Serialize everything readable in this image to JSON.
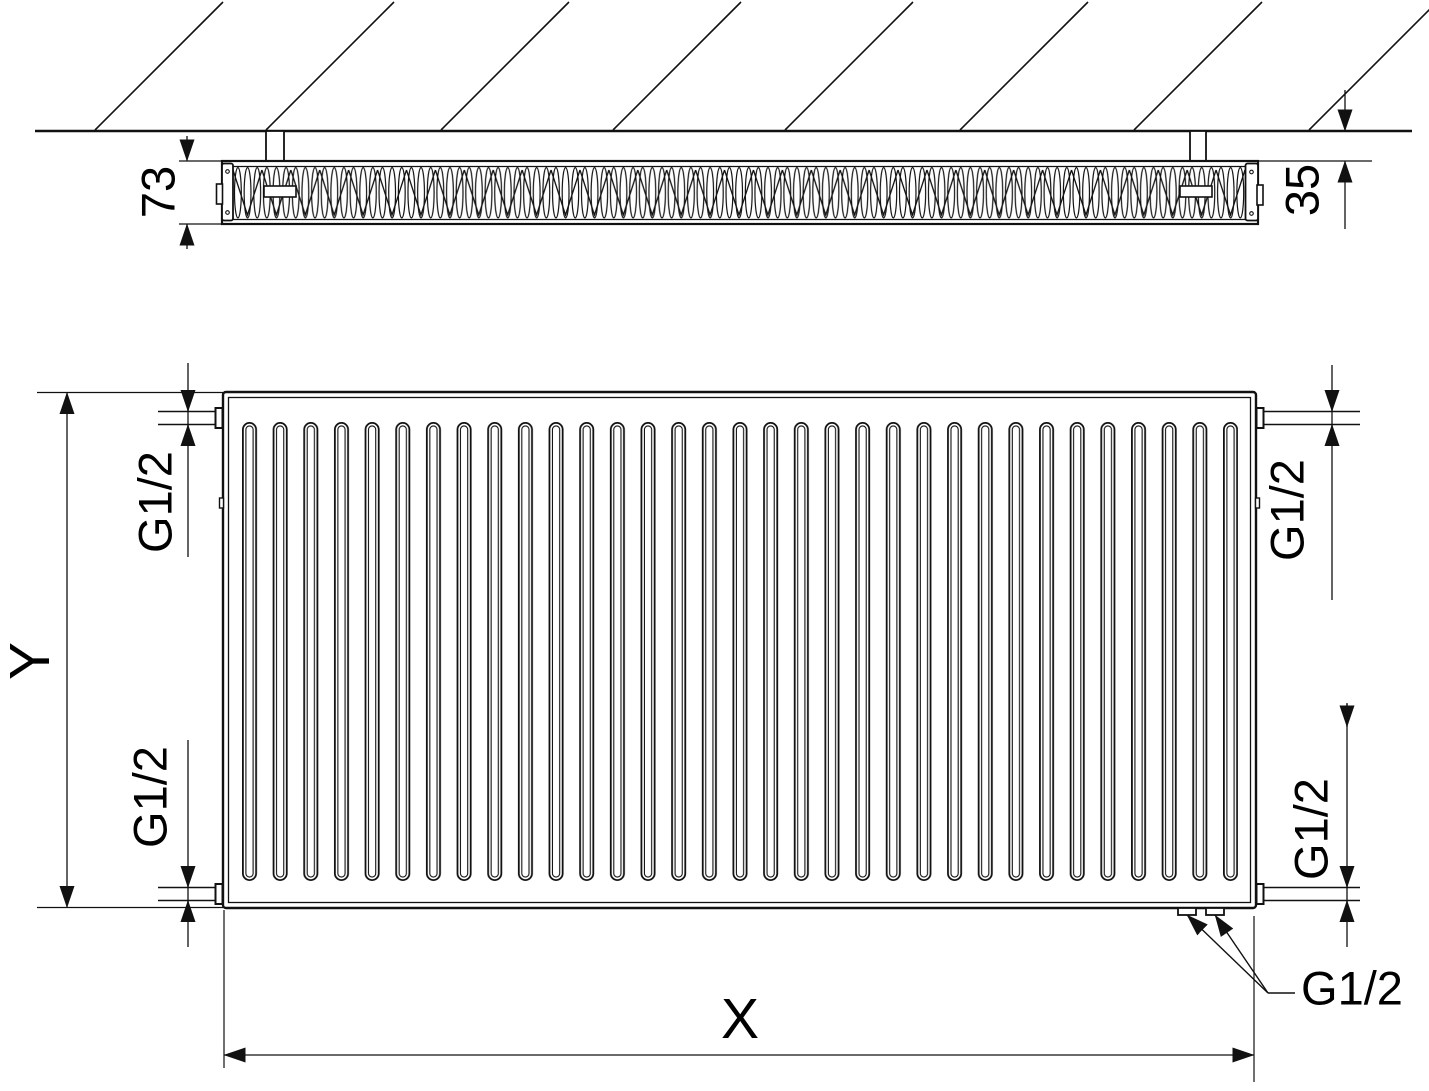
{
  "colors": {
    "line": "#111111",
    "text": "#000000",
    "background": "#ffffff"
  },
  "top_view": {
    "depth_label": "73",
    "wall_gap_label": "35"
  },
  "front_view": {
    "height_label": "Y",
    "width_label": "X",
    "conn_top_left": "G1/2",
    "conn_bottom_left": "G1/2",
    "conn_top_right": "G1/2",
    "conn_bottom_right": "G1/2",
    "conn_bottom_leader": "G1/2"
  }
}
